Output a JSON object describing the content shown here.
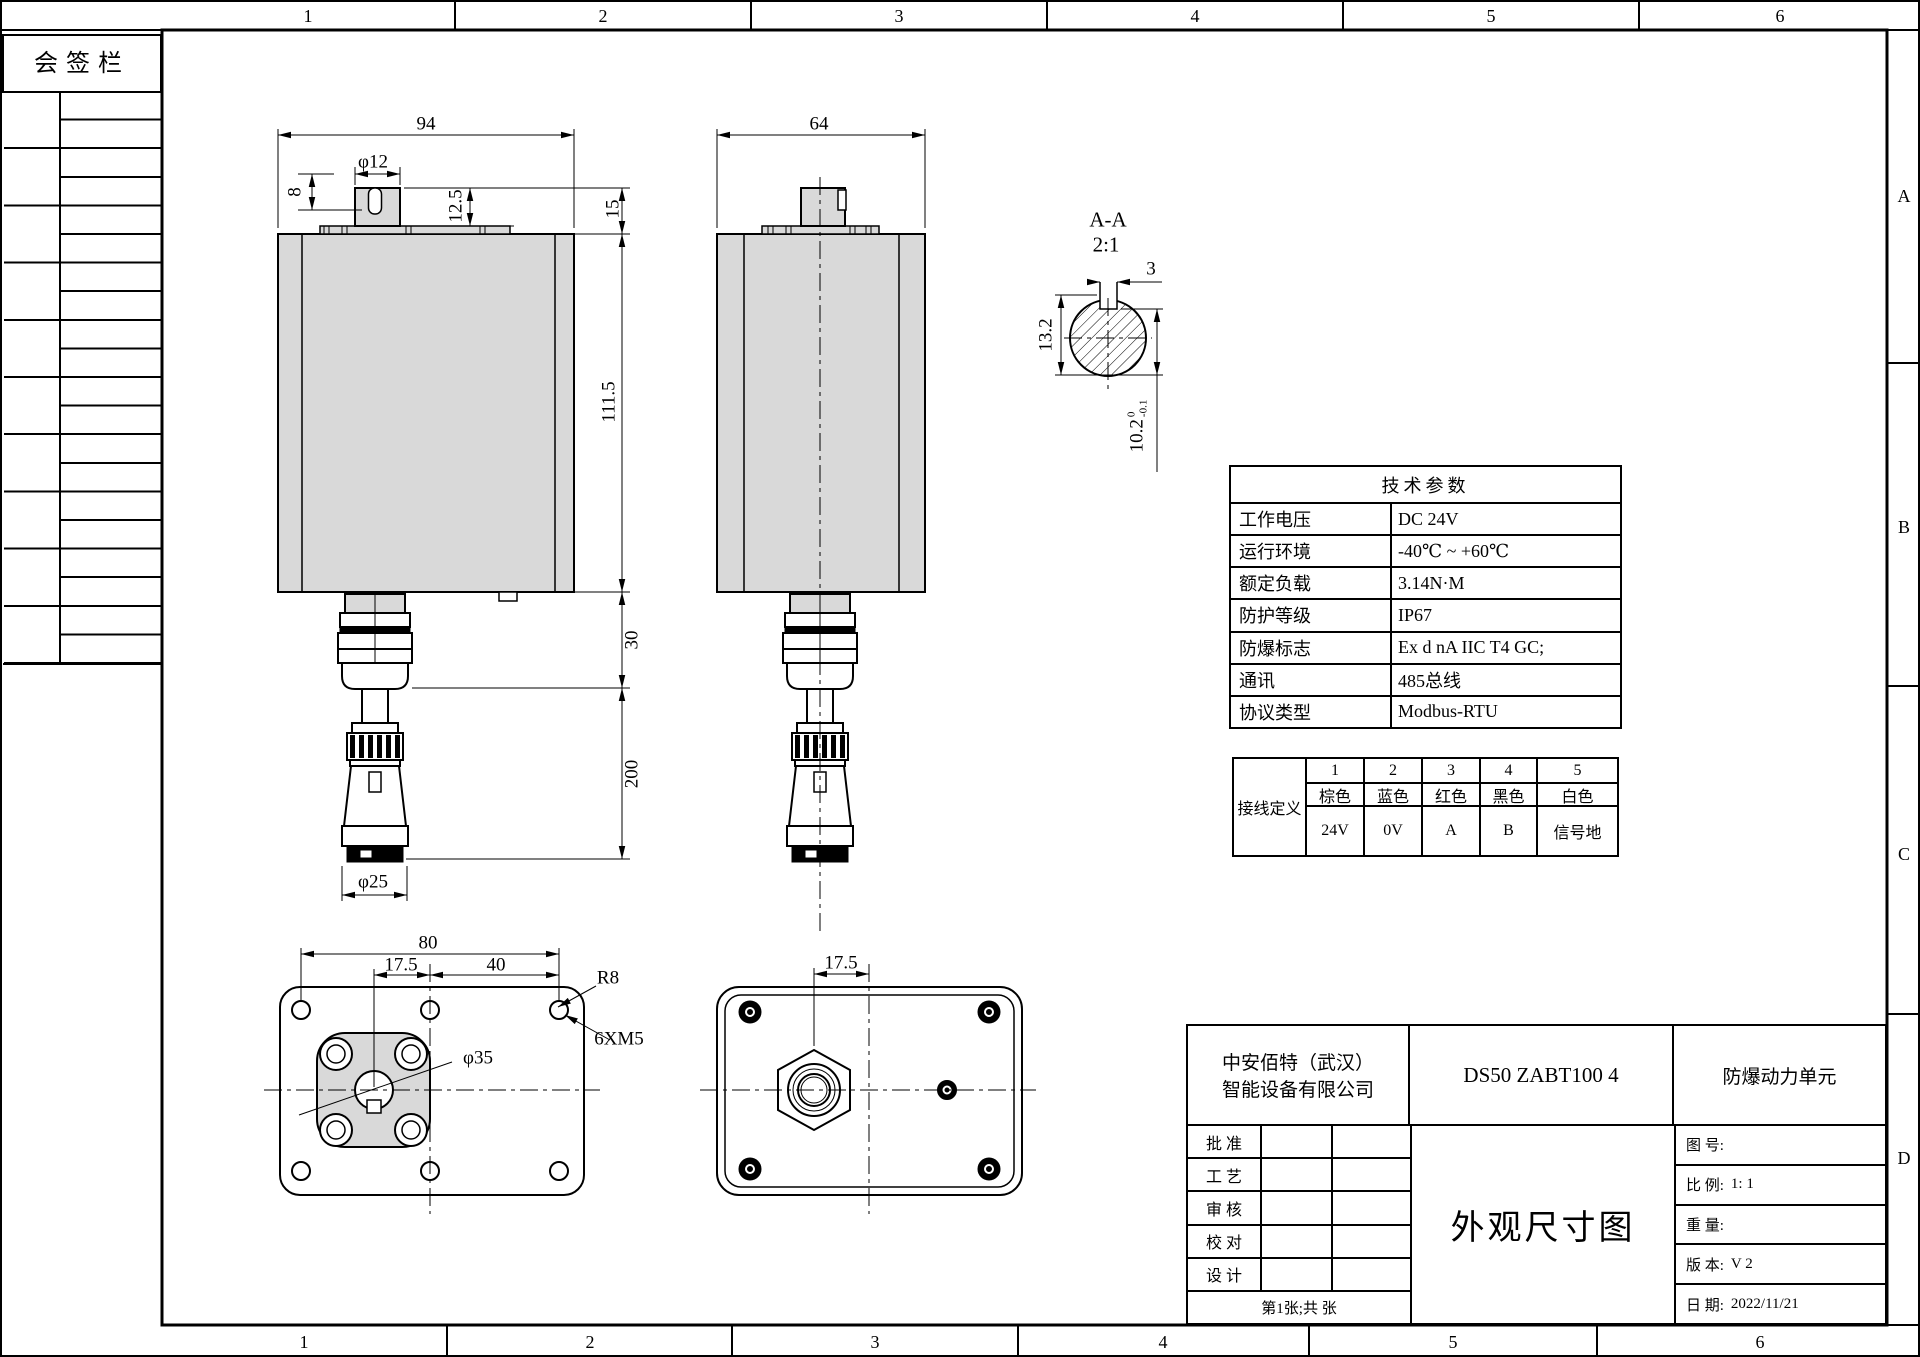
{
  "border": {
    "top_columns": [
      "1",
      "2",
      "3",
      "4",
      "5",
      "6"
    ],
    "bottom_columns": [
      "1",
      "2",
      "3",
      "4",
      "5",
      "6"
    ],
    "right_rows": [
      "A",
      "B",
      "C",
      "D"
    ]
  },
  "signature_panel": {
    "title": "会签栏"
  },
  "front_view": {
    "dims": {
      "width": "94",
      "shaft_dia": "φ12",
      "key_len": "8",
      "key_depth": "12.5",
      "boss_height": "15",
      "body_height": "111.5",
      "gland_length": "30",
      "cable_length": "200",
      "connector_dia": "φ25"
    }
  },
  "side_view": {
    "dims": {
      "width": "64"
    }
  },
  "section_view": {
    "label": "A-A",
    "scale": "2:1",
    "dims": {
      "key_width": "3",
      "shaft_dia": "13.2",
      "across_flat": "10.2",
      "tol_upper": "0",
      "tol_lower": "-0.1"
    }
  },
  "bottom_view_left": {
    "dims": {
      "hole_span": "80",
      "center_offset": "17.5",
      "hole_pitch": "40",
      "corner_radius": "R8",
      "thread_callout": "6XM5",
      "flange_dia": "φ35"
    }
  },
  "bottom_view_right": {
    "dims": {
      "center_offset": "17.5"
    }
  },
  "tech_table": {
    "title": "技术参数",
    "rows": [
      {
        "label": "工作电压",
        "value": "DC 24V"
      },
      {
        "label": "运行环境",
        "value": "-40℃ ~ +60℃"
      },
      {
        "label": "额定负载",
        "value": "3.14N·M"
      },
      {
        "label": "防护等级",
        "value": "IP67"
      },
      {
        "label": "防爆标志",
        "value": "Ex d nA IIC T4 GC;"
      },
      {
        "label": "通讯",
        "value": "485总线"
      },
      {
        "label": "协议类型",
        "value": "Modbus-RTU"
      }
    ]
  },
  "wiring_table": {
    "header": "接线定义",
    "pins": [
      "1",
      "2",
      "3",
      "4",
      "5"
    ],
    "colors": [
      "棕色",
      "蓝色",
      "红色",
      "黑色",
      "白色"
    ],
    "signals": [
      "24V",
      "0V",
      "A",
      "B",
      "信号地"
    ]
  },
  "title_block": {
    "company": "中安佰特（武汉） 智能设备有限公司",
    "model": "DS50 ZABT100 4",
    "product": "防爆动力单元",
    "approval_rows": [
      "批 准",
      "工 艺",
      "审 核",
      "校 对",
      "设 计"
    ],
    "sheet_note": "第1张;共 张",
    "drawing_title": "外观尺寸图",
    "fields": [
      {
        "label": "图 号:",
        "value": ""
      },
      {
        "label": "比 例:",
        "value": "1: 1"
      },
      {
        "label": "重 量:",
        "value": ""
      },
      {
        "label": "版 本:",
        "value": "V 2"
      },
      {
        "label": "日 期:",
        "value": "2022/11/21"
      }
    ]
  },
  "colors": {
    "line": "#000000",
    "body_fill": "#d9d9d9",
    "paper": "#ffffff"
  }
}
